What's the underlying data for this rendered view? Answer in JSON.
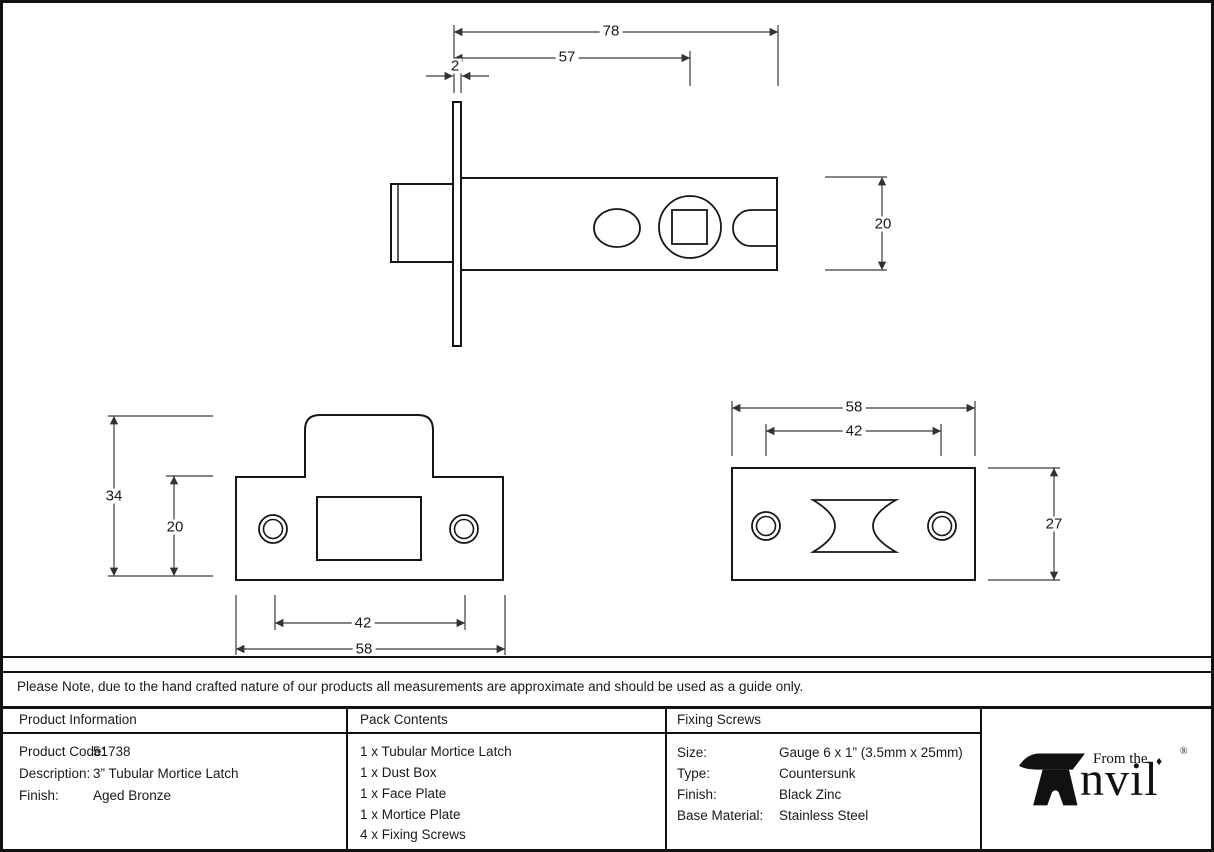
{
  "drawings": {
    "latch_view": {
      "overall_length": "78",
      "backset": "57",
      "faceplate_thickness": "2",
      "height": "20"
    },
    "faceplate_view": {
      "overall_height": "34",
      "plate_height": "20",
      "hole_centres": "42",
      "width": "58"
    },
    "morticeplate_view": {
      "width": "58",
      "hole_centres": "42",
      "height": "27"
    }
  },
  "note": "Please Note, due to the hand crafted nature of our products all measurements are approximate and should be used as a guide only.",
  "table": {
    "product_information": {
      "title": "Product Information",
      "rows": [
        {
          "label": "Product Code:",
          "value": "51738"
        },
        {
          "label": "Description:",
          "value": "3” Tubular Mortice Latch"
        },
        {
          "label": "Finish:",
          "value": "Aged Bronze"
        }
      ]
    },
    "pack_contents": {
      "title": "Pack Contents",
      "items": [
        "1 x Tubular Mortice Latch",
        "1 x Dust Box",
        "1 x Face Plate",
        "1 x Mortice Plate",
        "4 x Fixing Screws"
      ]
    },
    "fixing_screws": {
      "title": "Fixing Screws",
      "rows": [
        {
          "label": "Size:",
          "value": "Gauge 6 x 1” (3.5mm x 25mm)"
        },
        {
          "label": "Type:",
          "value": "Countersunk"
        },
        {
          "label": "Finish:",
          "value": "Black Zinc"
        },
        {
          "label": "Base Material:",
          "value": "Stainless Steel"
        }
      ]
    },
    "logo": {
      "from_the": "From the",
      "brand_rest": "nvil",
      "diamond": "♦",
      "registered": "®"
    }
  }
}
